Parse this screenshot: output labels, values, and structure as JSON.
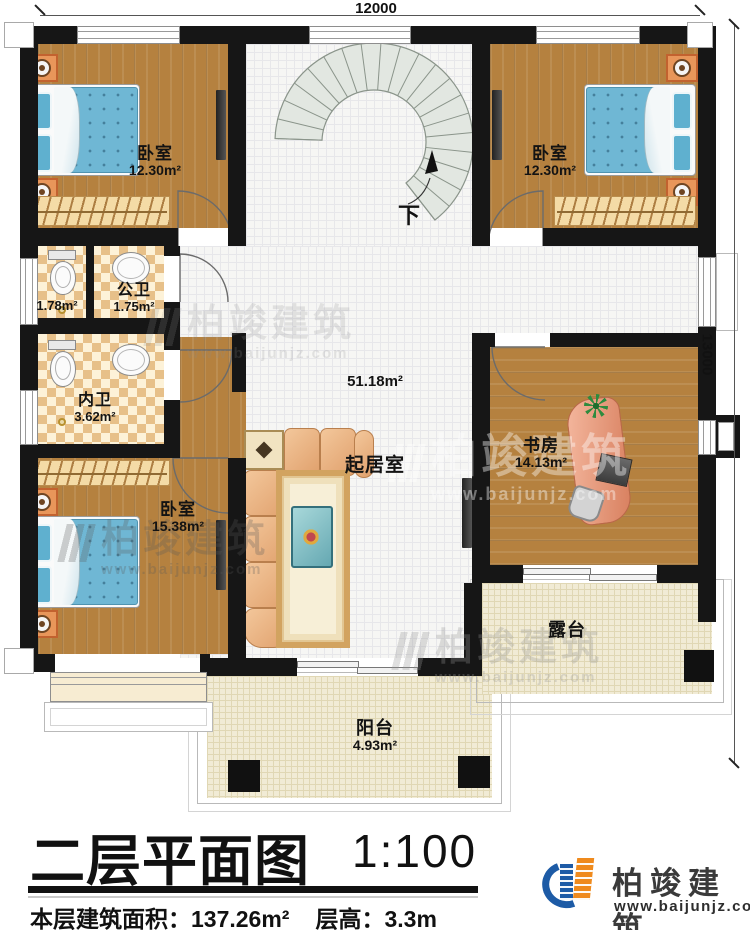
{
  "plan": {
    "dimensions": {
      "width_label": "12000",
      "height_label": "13000"
    },
    "stairs": {
      "down_label": "下"
    },
    "rooms": [
      {
        "key": "bedroom-top-left",
        "name": "卧室",
        "area": "12.30m²"
      },
      {
        "key": "bedroom-top-right",
        "name": "卧室",
        "area": "12.30m²"
      },
      {
        "key": "public-bathroom",
        "name": "公卫",
        "area": "1.75m²",
        "shower_area": "1.78m²"
      },
      {
        "key": "private-bathroom",
        "name": "内卫",
        "area": "3.62m²"
      },
      {
        "key": "bedroom-bottom-left",
        "name": "卧室",
        "area": "15.38m²"
      },
      {
        "key": "living-room",
        "name": "起居室",
        "area": "51.18m²"
      },
      {
        "key": "study",
        "name": "书房",
        "area": "14.13m²"
      },
      {
        "key": "balcony",
        "name": "阳台",
        "area": "4.93m²"
      },
      {
        "key": "terrace",
        "name": "露台"
      }
    ]
  },
  "watermark": {
    "brand": "柏竣建筑",
    "website": "www.baijunjz.com"
  },
  "title_block": {
    "title": "二层平面图",
    "scale": "1:100",
    "floor_area_label": "本层建筑面积：",
    "floor_area_value": "137.26m²",
    "floor_height_label": "层高：",
    "floor_height_value": "3.3m"
  },
  "logo": {
    "brand": "柏竣建筑",
    "website": "www.baijunjz.com"
  },
  "colors": {
    "wall": "#161616",
    "wood_floor": "#b5813f",
    "tile_floor": "#f6f6f4",
    "outdoor_floor": "#f1ebd5",
    "bathroom_tile": "#e7c089",
    "bed": "#6fb7d4",
    "sofa": "#eeb387",
    "desk": "#e49a7c",
    "logo_blue": "#1d5ba6",
    "logo_orange": "#ef8a1d"
  }
}
